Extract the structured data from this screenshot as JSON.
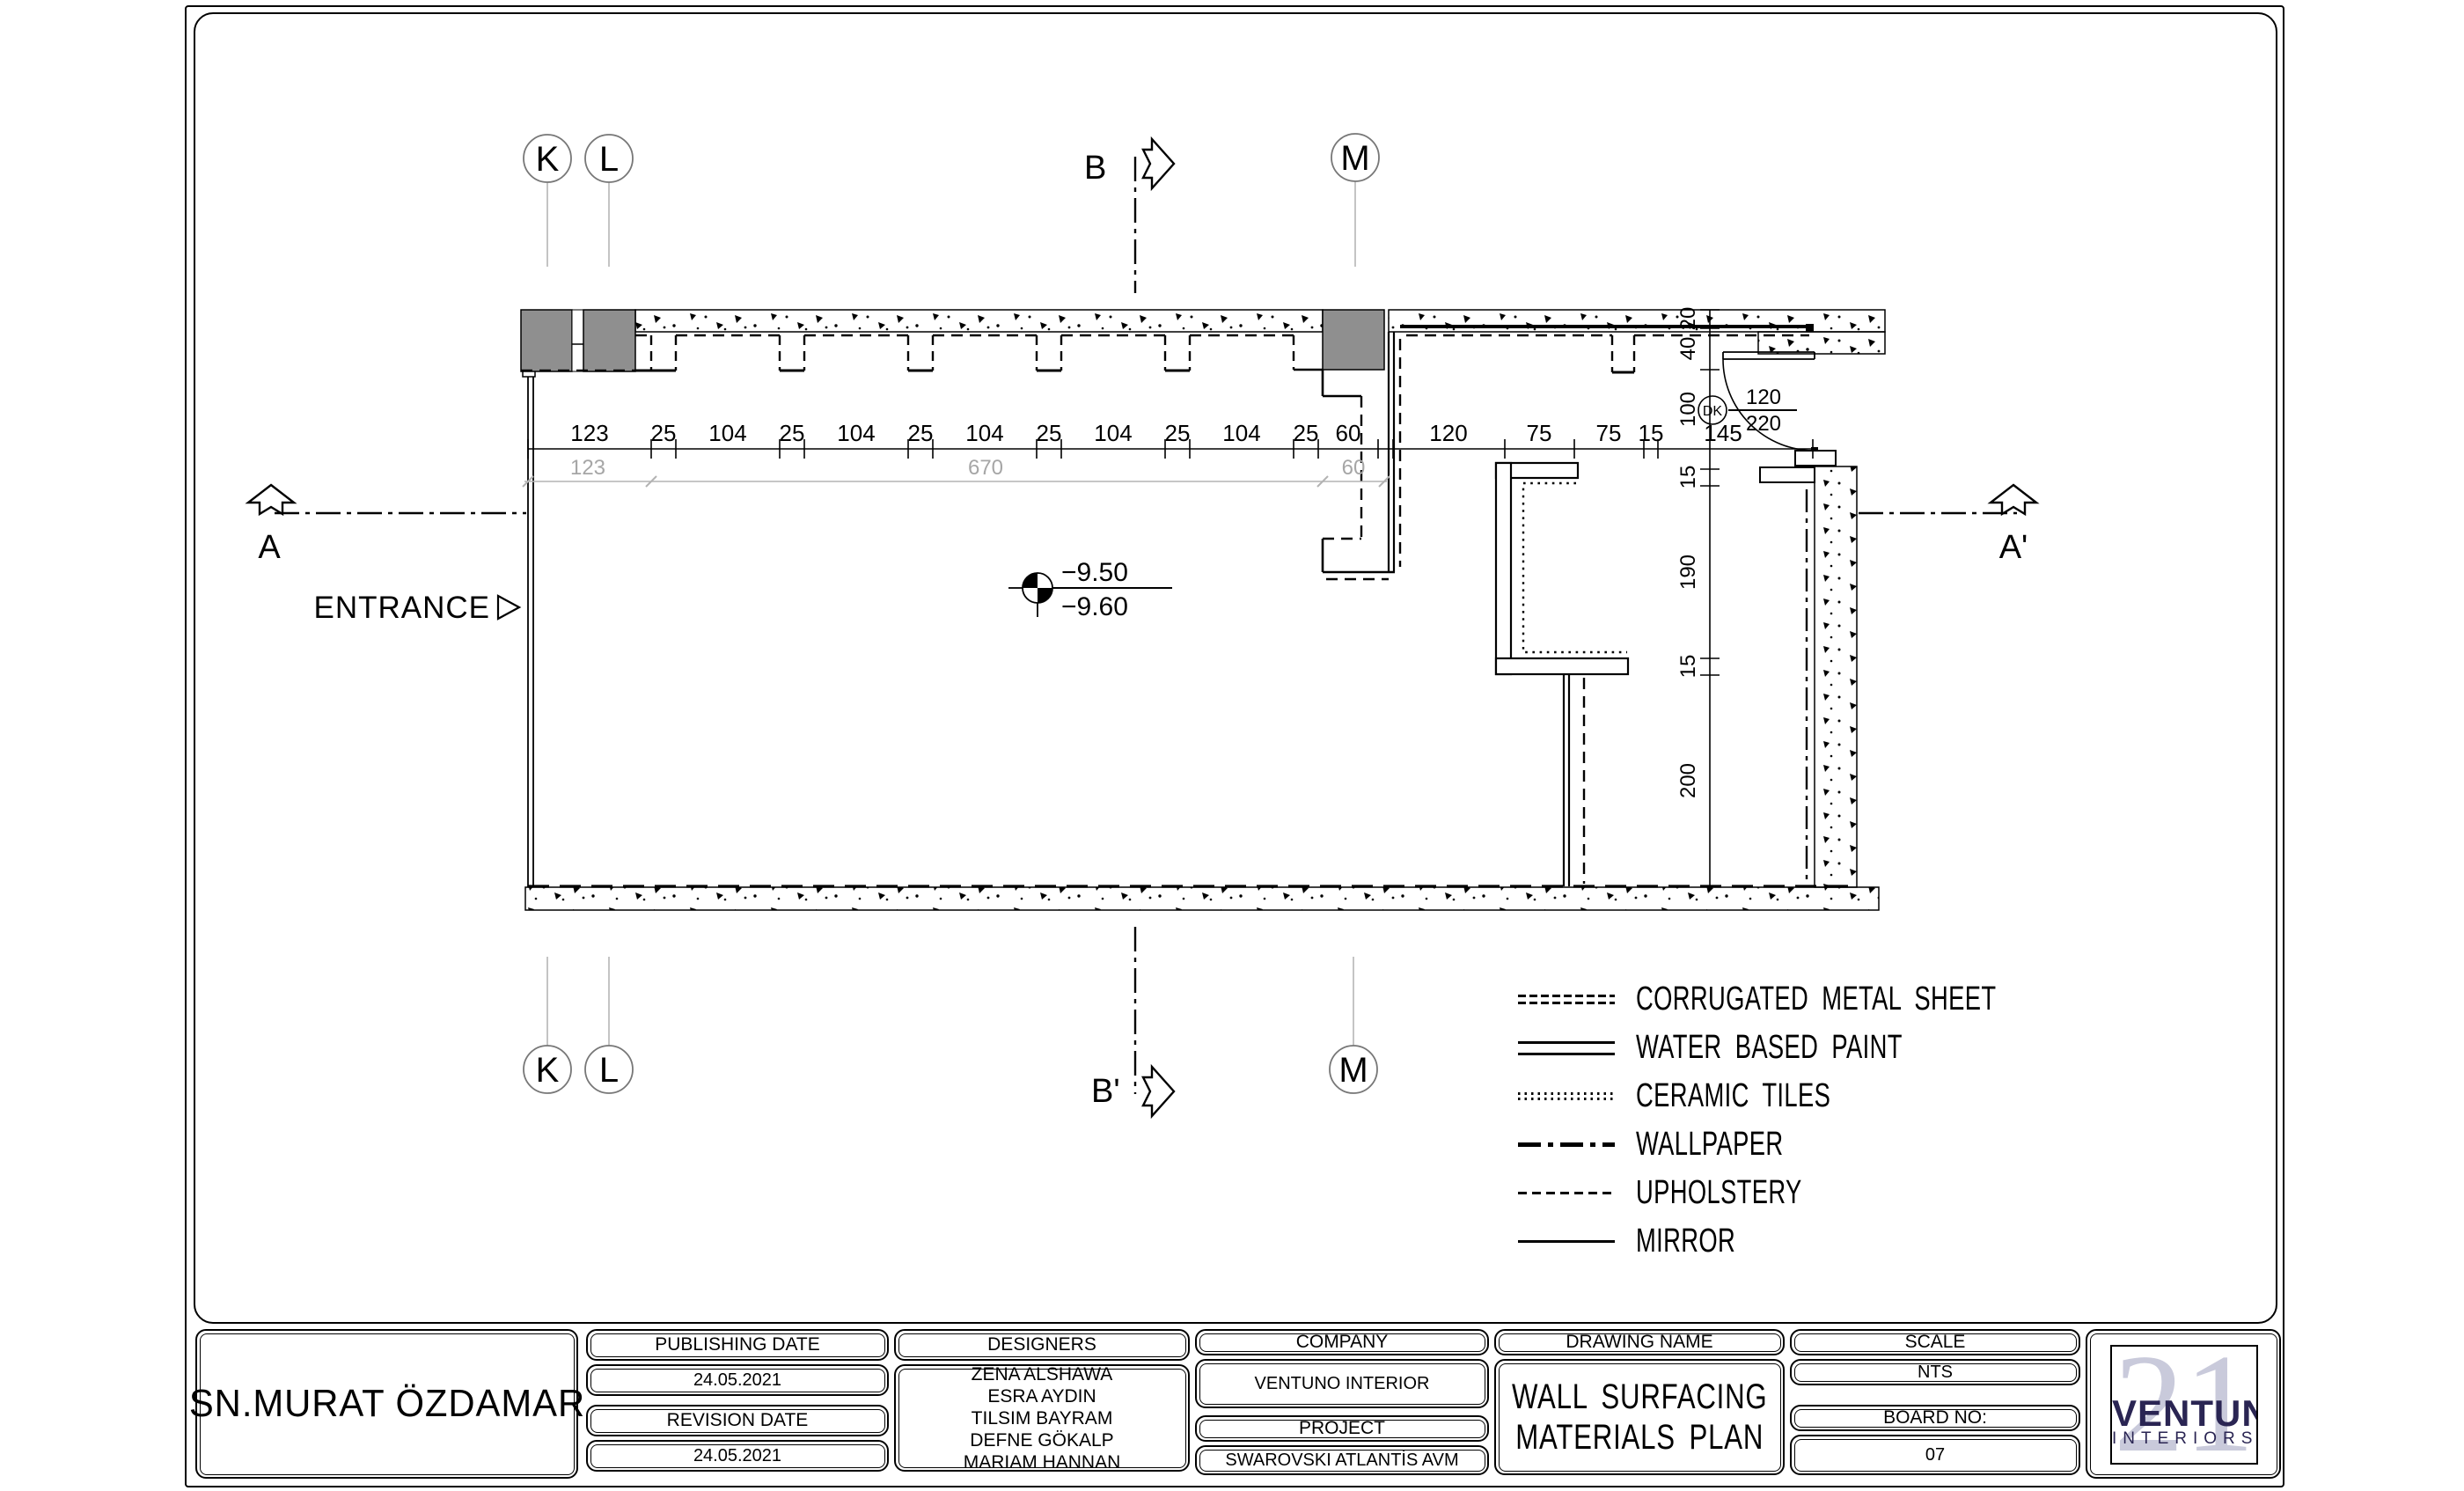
{
  "plan": {
    "markers": {
      "k": "K",
      "l": "L",
      "m": "M",
      "a": "A",
      "a_prime": "A'",
      "b": "B",
      "b_prime": "B'"
    },
    "entrance_label": "ENTRANCE",
    "elevation": {
      "upper": "−9.50",
      "lower": "−9.60"
    },
    "door": {
      "tag": "DK",
      "num": "120",
      "den": "220"
    },
    "dims_top": [
      "123",
      "25",
      "104",
      "25",
      "104",
      "25",
      "104",
      "25",
      "104",
      "25",
      "104",
      "25",
      "60",
      "120",
      "75",
      "75",
      "15",
      "145"
    ],
    "dims_gray": [
      "123",
      "670",
      "60"
    ],
    "dims_right": [
      "20",
      "40",
      "100",
      "15",
      "190",
      "15",
      "200"
    ]
  },
  "legend": {
    "items": [
      {
        "label": "CORRUGATED METAL SHEET"
      },
      {
        "label": "WATER BASED PAINT"
      },
      {
        "label": "CERAMIC TILES"
      },
      {
        "label": "WALLPAPER"
      },
      {
        "label": "UPHOLSTERY"
      },
      {
        "label": "MIRROR"
      }
    ]
  },
  "titleblock": {
    "client": "SN.MURAT ÖZDAMAR",
    "publishing_date_label": "PUBLISHING DATE",
    "publishing_date": "24.05.2021",
    "revision_date_label": "REVISION DATE",
    "revision_date": "24.05.2021",
    "designers_label": "DESIGNERS",
    "designers": [
      "ZENA ALSHAWA",
      "ESRA AYDIN",
      "TILSIM BAYRAM",
      "DEFNE GÖKALP",
      "MARIAM HANNAN"
    ],
    "company_label": "COMPANY",
    "company": "VENTUNO INTERIOR",
    "project_label": "PROJECT",
    "project": "SWAROVSKI ATLANTİS AVM",
    "drawing_name_label": "DRAWING NAME",
    "drawing_name_line1": "WALL SURFACING",
    "drawing_name_line2": "MATERIALS PLAN",
    "scale_label": "SCALE",
    "scale": "NTS",
    "board_label": "BOARD NO:",
    "board": "07",
    "logo": {
      "numeral": "21",
      "brand": "VENTUNO",
      "sub": "INTERIORS",
      "brand_color": "#2a2553",
      "numeral_color": "#c9cadb"
    }
  }
}
